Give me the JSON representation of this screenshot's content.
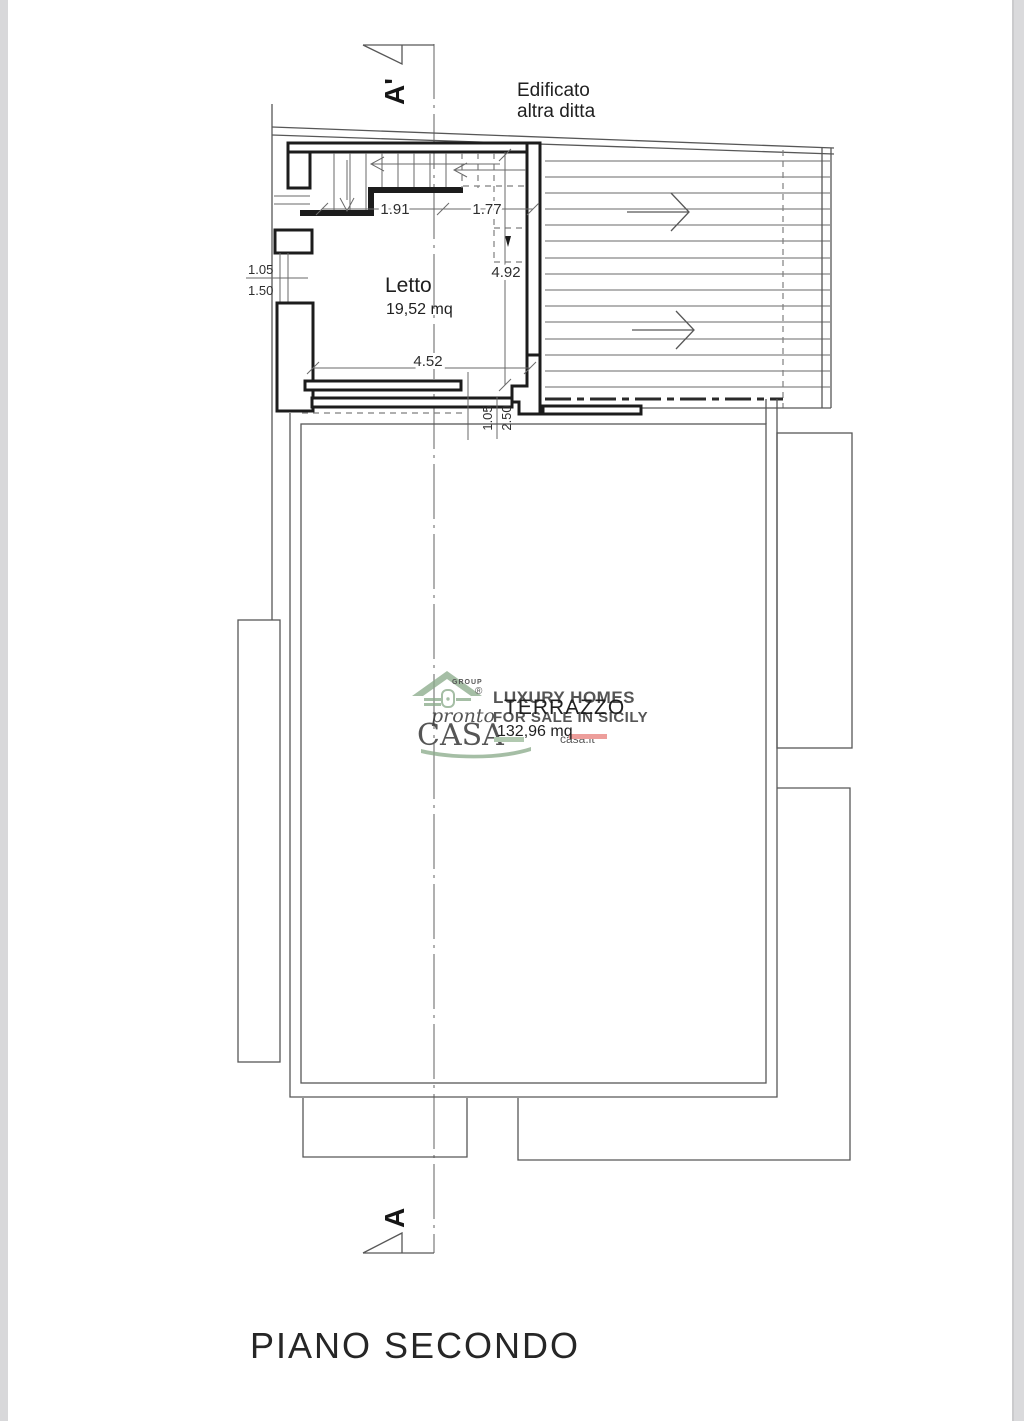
{
  "page": {
    "title": "PIANO SECONDO"
  },
  "plan": {
    "neighbor_label": {
      "line1": "Edificato",
      "line2": "altra ditta"
    },
    "section_markers": {
      "top": "A'",
      "bottom": "A"
    },
    "rooms": {
      "letto": {
        "name": "Letto",
        "area": "19,52 mq"
      },
      "terrazzo": {
        "name": "TERRAZZO",
        "area": "132,96 mq"
      }
    },
    "dimensions": {
      "stair_left": "1.91",
      "stair_right": "1.77",
      "room_depth": "4.92",
      "room_width": "4.52",
      "left_window_upper": "1.05",
      "left_window_lower": "1.50",
      "terrace_door_upper": "1.05",
      "terrace_door_lower": "2.50"
    }
  },
  "watermark": {
    "group_label": "GROUP",
    "registered_mark": "®",
    "brand_script": "pronto",
    "brand_caps": "CASA",
    "tagline_line1": "LUXURY HOMES",
    "tagline_line2": "FOR SALE IN SICILY",
    "website_fragment": "casa.it",
    "colors": {
      "green": "#8dac8c",
      "red": "#c9473d",
      "gray_text": "#a3aaa6",
      "flag_green": "#9cbb9a",
      "flag_red": "#e8837f"
    }
  }
}
